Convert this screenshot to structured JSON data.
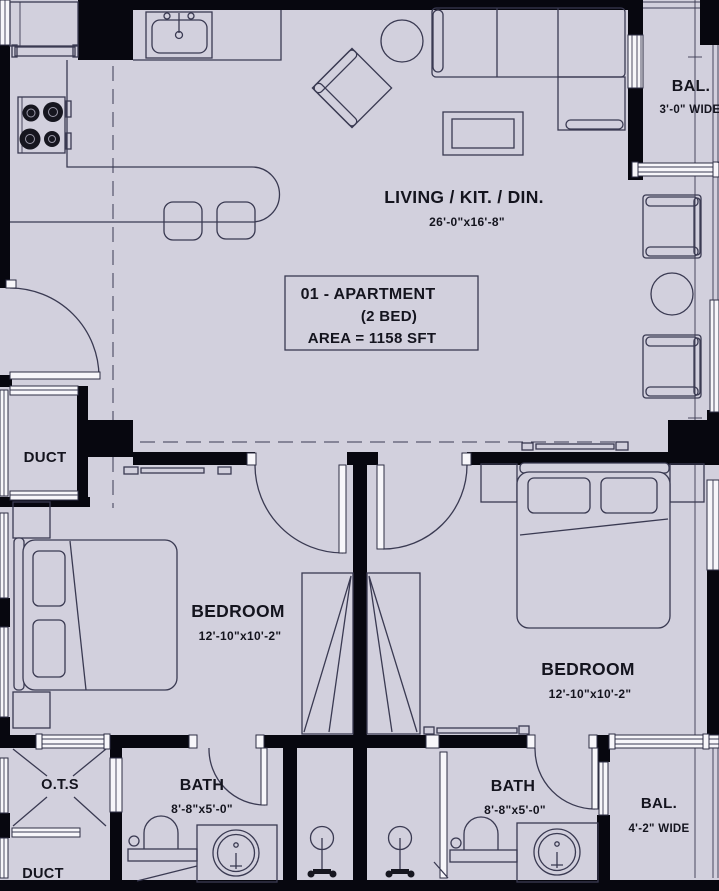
{
  "document": {
    "type": "apartment-floor-plan"
  },
  "title_box": {
    "line1": "01 - APARTMENT",
    "line2": "(2 BED)",
    "line3": "AREA = 1158 SFT"
  },
  "rooms": {
    "living": {
      "label": "LIVING / KIT. / DIN.",
      "dims": "26'-0\"x16'-8\""
    },
    "balcony_top": {
      "label": "BAL.",
      "dims": "3'-0\" WIDE"
    },
    "duct_mid": {
      "label": "DUCT"
    },
    "bedroom_left": {
      "label": "BEDROOM",
      "dims": "12'-10\"x10'-2\""
    },
    "bedroom_right": {
      "label": "BEDROOM",
      "dims": "12'-10\"x10'-2\""
    },
    "ots": {
      "label": "O.T.S"
    },
    "bath_left": {
      "label": "BATH",
      "dims": "8'-8\"x5'-0\""
    },
    "bath_right": {
      "label": "BATH",
      "dims": "8'-8\"x5'-0\""
    },
    "balcony_bottom": {
      "label": "BAL.",
      "dims": "4'-2\" WIDE"
    },
    "duct_bottom": {
      "label": "DUCT"
    }
  },
  "colors": {
    "background": "#d2d0dd",
    "wall": "#07070f",
    "line": "#3a3a52",
    "text": "#14141e",
    "window": "#f7f6fa"
  }
}
